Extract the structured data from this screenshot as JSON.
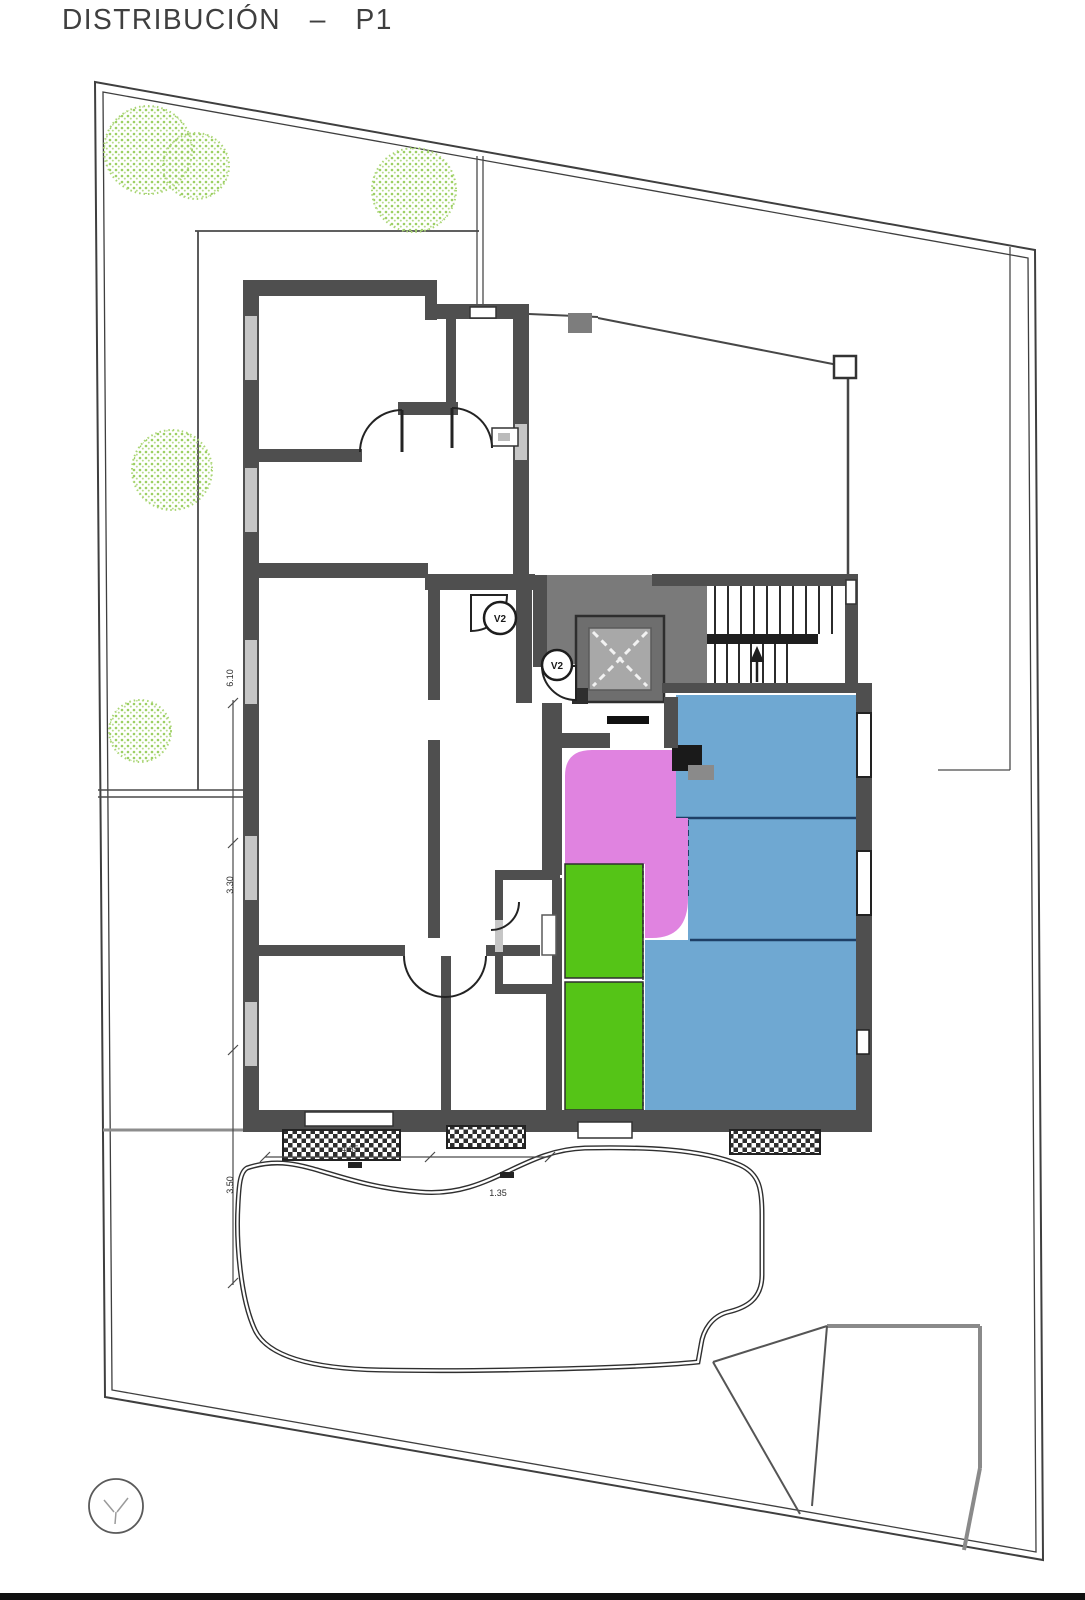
{
  "title": "DISTRIBUCIÓN – P1",
  "plan": {
    "floor_label": "P1",
    "vent_symbol_label": "V2",
    "dimensions": {
      "left_top": "6.10",
      "left_mid": "3.30",
      "left_bottom": "3.50",
      "bottom_left": "4.35",
      "bottom_mid": "1.35"
    }
  },
  "colors": {
    "zone_blue": "#6FA8D2",
    "zone_magenta": "#E083E0",
    "zone_green": "#55C417",
    "zone_divider_navy": "#1E3F66",
    "core_gray": "#7A7A7A",
    "wall_gray": "#4F4F4F",
    "line_gray": "#3F3F3F",
    "tree_green": "#9CCF63"
  }
}
